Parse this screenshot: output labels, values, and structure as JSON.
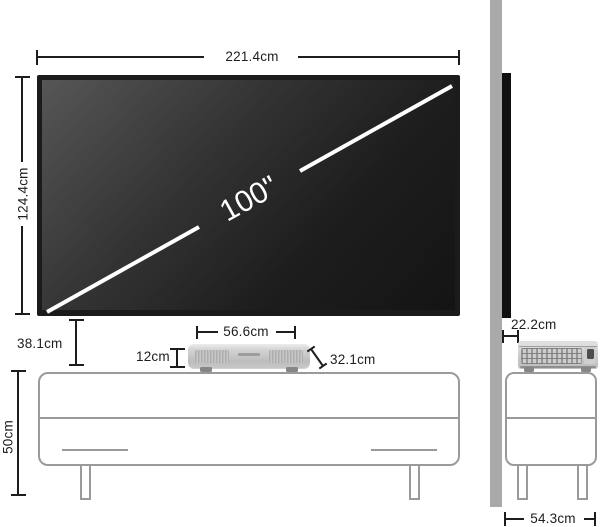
{
  "diagram": {
    "front": {
      "screen_width": "221.4cm",
      "screen_height": "124.4cm",
      "diagonal": "100\"",
      "gap_screen_to_cabinet": "38.1cm",
      "projector_height": "12cm",
      "projector_width": "56.6cm",
      "projector_depth": "32.1cm",
      "cabinet_height": "50cm"
    },
    "side": {
      "wall_to_projector": "22.2cm",
      "cabinet_depth": "54.3cm"
    }
  },
  "colors": {
    "dimension_line": "#1d1d1d",
    "outline_gray": "#9a9a9a",
    "wall_gray": "#a9a9a9",
    "screen_black": "#1b1b1b",
    "diagonal_line": "#ffffff",
    "projector_silver": "#c9c9c9"
  }
}
